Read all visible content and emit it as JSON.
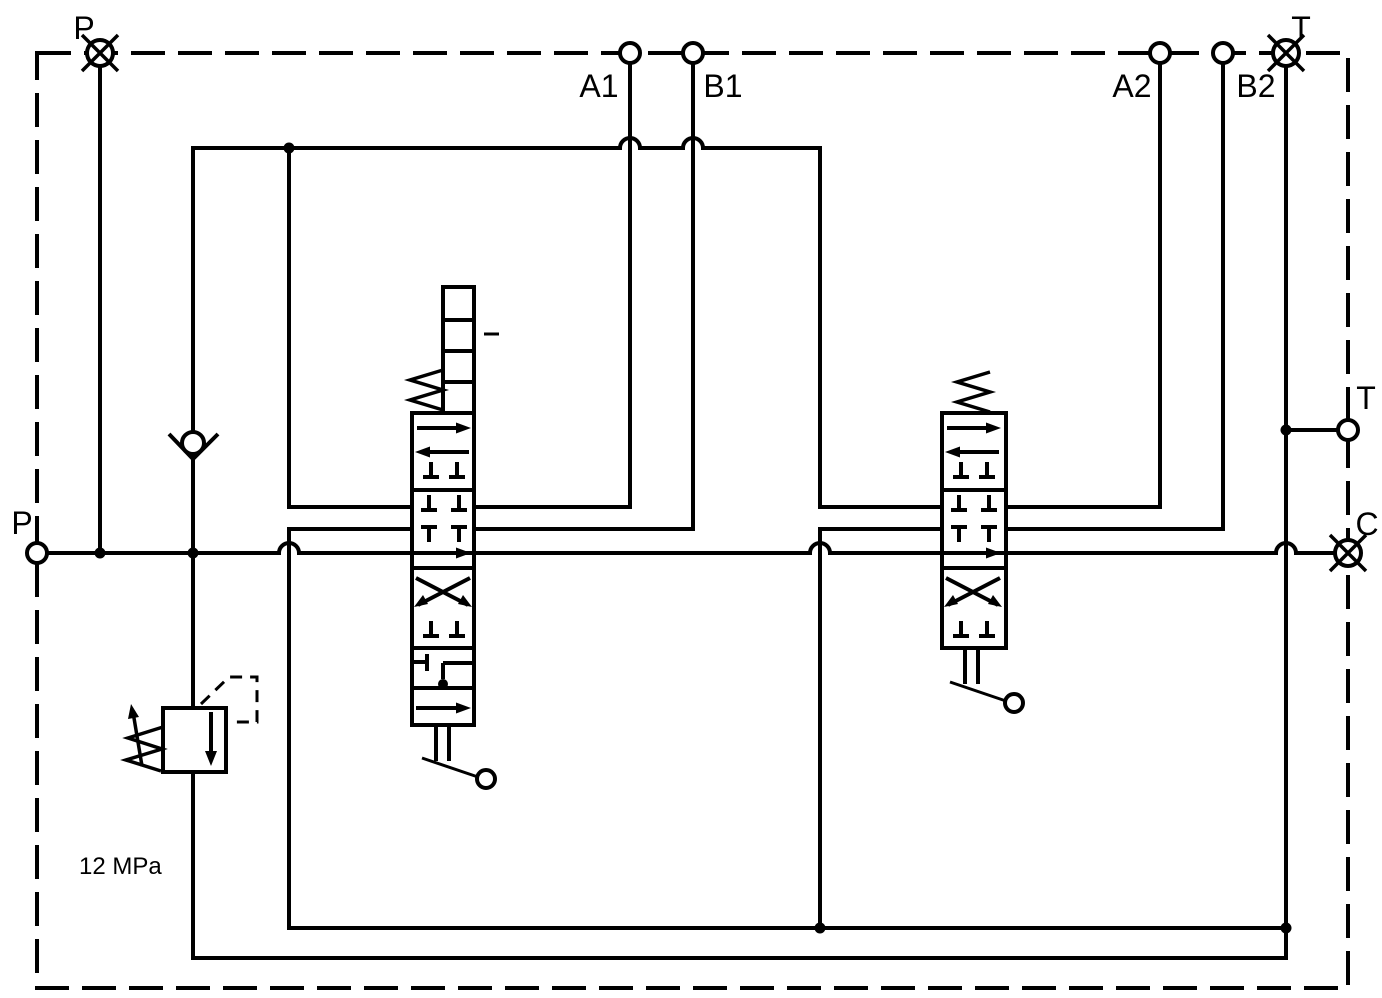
{
  "page": {
    "background": "#ffffff",
    "line_color": "#000000"
  },
  "schematic": {
    "pressure_setting": "12 MPa",
    "port_labels": {
      "p_top": "P",
      "t_top": "T",
      "a1": "A1",
      "b1": "B1",
      "a2": "A2",
      "b2": "B2",
      "p_left": "P",
      "t_right": "T",
      "c_right": "C"
    },
    "icons": {
      "plugged_port": "circle-with-x-icon",
      "open_port": "circle-port-icon",
      "check_valve": "check-valve-icon",
      "relief_valve": "relief-valve-icon",
      "spring": "spring-icon",
      "lever": "lever-handle-icon",
      "detent": "detent-ladder-icon",
      "junction": "junction-dot",
      "line_jump": "line-hop-arc"
    }
  }
}
